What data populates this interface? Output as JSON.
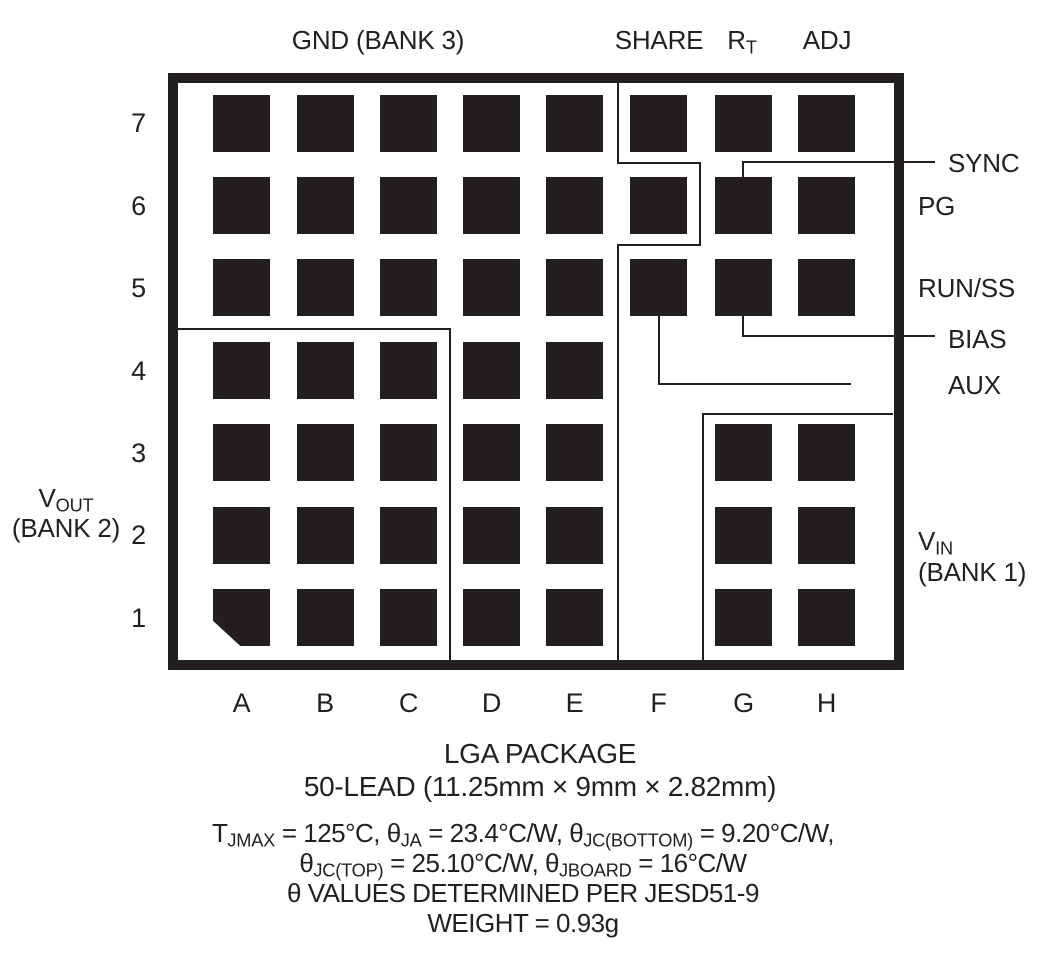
{
  "package": {
    "top_labels": {
      "gnd": "GND (BANK 3)",
      "share": "SHARE",
      "rt": [
        {
          "t": "R"
        },
        {
          "s": "T"
        }
      ],
      "adj": "ADJ"
    },
    "right_labels": {
      "sync": "SYNC",
      "pg": "PG",
      "run_ss": "RUN/SS",
      "bias": "BIAS",
      "aux": "AUX",
      "vin_line1": [
        {
          "t": "V"
        },
        {
          "s": "IN"
        }
      ],
      "vin_line2": "(BANK 1)"
    },
    "left_label": {
      "line1": [
        {
          "t": "V"
        },
        {
          "s": "OUT"
        }
      ],
      "line2": "(BANK 2)"
    },
    "row_labels": [
      "7",
      "6",
      "5",
      "4",
      "3",
      "2",
      "1"
    ],
    "col_labels": [
      "A",
      "B",
      "C",
      "D",
      "E",
      "F",
      "G",
      "H"
    ],
    "pad_rows": [
      {
        "row": "7",
        "cols": [
          "A",
          "B",
          "C",
          "D",
          "E",
          "F",
          "G",
          "H"
        ]
      },
      {
        "row": "6",
        "cols": [
          "A",
          "B",
          "C",
          "D",
          "E",
          "F",
          "G",
          "H"
        ]
      },
      {
        "row": "5",
        "cols": [
          "A",
          "B",
          "C",
          "D",
          "E",
          "F",
          "G",
          "H"
        ]
      },
      {
        "row": "4",
        "cols": [
          "A",
          "B",
          "C",
          "D",
          "E"
        ]
      },
      {
        "row": "3",
        "cols": [
          "A",
          "B",
          "C",
          "D",
          "E",
          "G",
          "H"
        ]
      },
      {
        "row": "2",
        "cols": [
          "A",
          "B",
          "C",
          "D",
          "E",
          "G",
          "H"
        ]
      },
      {
        "row": "1",
        "cols": [
          "A",
          "B",
          "C",
          "D",
          "E",
          "G",
          "H"
        ],
        "chamfer": [
          "A"
        ]
      }
    ],
    "callouts": [
      {
        "label": "SYNC",
        "target_pad": "G6"
      },
      {
        "label": "BIAS",
        "target_pad": "G5"
      },
      {
        "label": "AUX",
        "target_pad": "F5"
      }
    ],
    "colors": {
      "ink": "#231f20",
      "background": "#ffffff"
    }
  },
  "caption": {
    "line1": "LGA PACKAGE",
    "line2": "50-LEAD (11.25mm × 9mm × 2.82mm)"
  },
  "thermal": {
    "lines": [
      [
        {
          "t": "T"
        },
        {
          "s": "JMAX"
        },
        {
          "t": " = 125°C, θ"
        },
        {
          "s": "JA"
        },
        {
          "t": " = 23.4°C/W, θ"
        },
        {
          "s": "JC(BOTTOM)"
        },
        {
          "t": " = 9.20°C/W,"
        }
      ],
      [
        {
          "t": "θ"
        },
        {
          "s": "JC(TOP)"
        },
        {
          "t": " = 25.10°C/W, θ"
        },
        {
          "s": "JBOARD"
        },
        {
          "t": " = 16°C/W"
        }
      ],
      [
        {
          "t": "θ VALUES DETERMINED PER JESD51-9"
        }
      ],
      [
        {
          "t": "WEIGHT = 0.93g"
        }
      ]
    ]
  }
}
